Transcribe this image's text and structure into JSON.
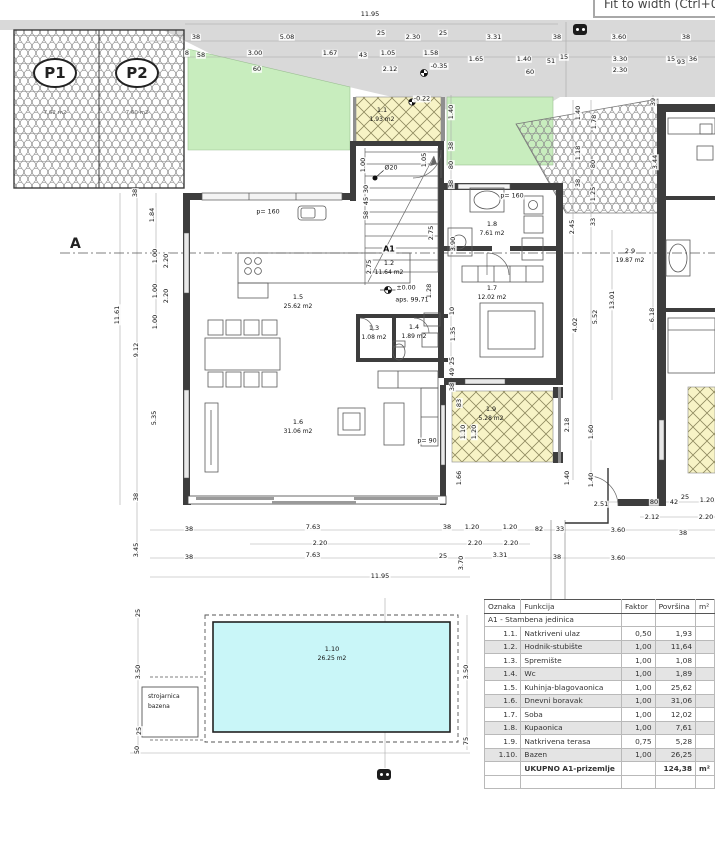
{
  "viewer": {
    "tooltip": "Fit to width (Ctrl+0)"
  },
  "section": {
    "label": "A"
  },
  "annotations": {
    "unit": "A1",
    "level_zero": "±0.00",
    "level_abs": "aps. 99,71",
    "elev_road": "-0.35",
    "elev_porch": "-0.22",
    "column": "Ø20",
    "parapet_kitchen": "p= 160",
    "parapet_bath": "p= 160",
    "parapet_living": "p= 90"
  },
  "parking": {
    "p1": {
      "label": "P1",
      "area": "7,62 m2"
    },
    "p2": {
      "label": "P2",
      "area": "7,60 m2"
    }
  },
  "rooms": {
    "r11": {
      "no": "1.1",
      "area": "1.93 m2"
    },
    "r12": {
      "no": "1.2",
      "area": "11.64 m2"
    },
    "r13": {
      "no": "1.3",
      "area": "1.08 m2"
    },
    "r14": {
      "no": "1.4",
      "area": "1.89 m2"
    },
    "r15": {
      "no": "1.5",
      "area": "25.62 m2"
    },
    "r16": {
      "no": "1.6",
      "area": "31.06 m2"
    },
    "r17": {
      "no": "1.7",
      "area": "12.02 m2"
    },
    "r18": {
      "no": "1.8",
      "area": "7.61 m2"
    },
    "r19": {
      "no": "1.9",
      "area": "5.28 m2"
    },
    "r110": {
      "no": "1.10",
      "area": "26.25 m2"
    },
    "r29": {
      "no": "2.9",
      "area": "19.87 m2"
    }
  },
  "pool": {
    "machine_room_line1": "strojarnica",
    "machine_room_line2": "bazena"
  },
  "legend": {
    "headers": [
      "Oznaka",
      "Funkcija",
      "Faktor",
      "Površina",
      "m²"
    ],
    "group": "A1 - Stambena jedinica",
    "rows": [
      [
        "1.1.",
        "Natkriveni ulaz",
        "0,50",
        "1,93"
      ],
      [
        "1.2.",
        "Hodnik-stubište",
        "1,00",
        "11,64"
      ],
      [
        "1.3.",
        "Spremište",
        "1,00",
        "1,08"
      ],
      [
        "1.4.",
        "Wc",
        "1,00",
        "1,89"
      ],
      [
        "1.5.",
        "Kuhinja-blagovaonica",
        "1,00",
        "25,62"
      ],
      [
        "1.6.",
        "Dnevni boravak",
        "1,00",
        "31,06"
      ],
      [
        "1.7.",
        "Soba",
        "1,00",
        "12,02"
      ],
      [
        "1.8.",
        "Kupaonica",
        "1,00",
        "7,61"
      ],
      [
        "1.9.",
        "Natkrivena terasa",
        "0,75",
        "5,28"
      ],
      [
        "1.10.",
        "Bazen",
        "1,00",
        "26,25"
      ]
    ],
    "total": {
      "label": "UKUPNO A1-prizemlje",
      "value": "124,38",
      "unit": "m²"
    }
  },
  "colors": {
    "road": "#d9d9d9",
    "grass": "#c8edbe",
    "terrace": "#f7f3c6",
    "pool": "#c9f6f8",
    "wall": "#3d3d3d"
  },
  "dims": [
    {
      "t": "11.95",
      "x": 370,
      "y": 14
    },
    {
      "t": "38",
      "x": 196,
      "y": 37
    },
    {
      "t": "5.08",
      "x": 287,
      "y": 37
    },
    {
      "t": "25",
      "x": 381,
      "y": 33
    },
    {
      "t": "2.30",
      "x": 413,
      "y": 37
    },
    {
      "t": "25",
      "x": 443,
      "y": 33
    },
    {
      "t": "3.31",
      "x": 494,
      "y": 37
    },
    {
      "t": "38",
      "x": 557,
      "y": 37
    },
    {
      "t": "3.60",
      "x": 619,
      "y": 37
    },
    {
      "t": "38",
      "x": 686,
      "y": 37
    },
    {
      "t": "8",
      "x": 187,
      "y": 53
    },
    {
      "t": "58",
      "x": 201,
      "y": 55
    },
    {
      "t": "3.00",
      "x": 255,
      "y": 53
    },
    {
      "t": "1.67",
      "x": 330,
      "y": 53
    },
    {
      "t": "43",
      "x": 363,
      "y": 55
    },
    {
      "t": "1.05",
      "x": 388,
      "y": 53
    },
    {
      "t": "1.58",
      "x": 431,
      "y": 53
    },
    {
      "t": "1.65",
      "x": 476,
      "y": 59
    },
    {
      "t": "1.40",
      "x": 524,
      "y": 59
    },
    {
      "t": "51",
      "x": 551,
      "y": 61
    },
    {
      "t": "15",
      "x": 564,
      "y": 57
    },
    {
      "t": "3.30",
      "x": 620,
      "y": 59
    },
    {
      "t": "15",
      "x": 671,
      "y": 59
    },
    {
      "t": "93",
      "x": 681,
      "y": 62
    },
    {
      "t": "36",
      "x": 693,
      "y": 59
    },
    {
      "t": "60",
      "x": 257,
      "y": 69
    },
    {
      "t": "2.12",
      "x": 390,
      "y": 69
    },
    {
      "t": "60",
      "x": 530,
      "y": 72
    },
    {
      "t": "2.30",
      "x": 620,
      "y": 70
    },
    {
      "t": "-0.35",
      "x": 439,
      "y": 66
    },
    {
      "t": "1.40",
      "x": 451,
      "y": 112,
      "r": 1
    },
    {
      "t": "38",
      "x": 451,
      "y": 146,
      "r": 1
    },
    {
      "t": "80",
      "x": 451,
      "y": 165,
      "r": 1
    },
    {
      "t": "38",
      "x": 451,
      "y": 184,
      "r": 1
    },
    {
      "t": "1.40",
      "x": 578,
      "y": 113,
      "r": 1
    },
    {
      "t": "1.78",
      "x": 594,
      "y": 122,
      "r": 1
    },
    {
      "t": "1.18",
      "x": 578,
      "y": 153,
      "r": 1
    },
    {
      "t": "80",
      "x": 593,
      "y": 164,
      "r": 1
    },
    {
      "t": "38",
      "x": 578,
      "y": 183,
      "r": 1
    },
    {
      "t": "1.25",
      "x": 593,
      "y": 194,
      "r": 1
    },
    {
      "t": "33",
      "x": 593,
      "y": 222,
      "r": 1
    },
    {
      "t": "2.45",
      "x": 572,
      "y": 227,
      "r": 1
    },
    {
      "t": "3.44",
      "x": 655,
      "y": 162,
      "r": 1
    },
    {
      "t": "39",
      "x": 653,
      "y": 102,
      "r": 1
    },
    {
      "t": "3.90",
      "x": 453,
      "y": 244,
      "r": 1
    },
    {
      "t": "1.00",
      "x": 363,
      "y": 165,
      "r": 1
    },
    {
      "t": "1.05",
      "x": 424,
      "y": 160,
      "r": 1
    },
    {
      "t": "30",
      "x": 366,
      "y": 189,
      "r": 1
    },
    {
      "t": "45",
      "x": 366,
      "y": 201,
      "r": 1
    },
    {
      "t": "58",
      "x": 366,
      "y": 215,
      "r": 1
    },
    {
      "t": "2.75",
      "x": 369,
      "y": 267,
      "r": 1
    },
    {
      "t": "2.75",
      "x": 431,
      "y": 233,
      "r": 1
    },
    {
      "t": "1.28",
      "x": 429,
      "y": 291,
      "r": 1
    },
    {
      "t": "10",
      "x": 452,
      "y": 311,
      "r": 1
    },
    {
      "t": "1.35",
      "x": 453,
      "y": 334,
      "r": 1
    },
    {
      "t": "25",
      "x": 452,
      "y": 361,
      "r": 1
    },
    {
      "t": "49",
      "x": 452,
      "y": 372,
      "r": 1
    },
    {
      "t": "38",
      "x": 452,
      "y": 387,
      "r": 1
    },
    {
      "t": "38",
      "x": 135,
      "y": 193,
      "r": 1
    },
    {
      "t": "1.84",
      "x": 152,
      "y": 215,
      "r": 1
    },
    {
      "t": "1.00",
      "x": 155,
      "y": 256,
      "r": 1
    },
    {
      "t": "2.20",
      "x": 166,
      "y": 261,
      "r": 1
    },
    {
      "t": "1.00",
      "x": 155,
      "y": 291,
      "r": 1
    },
    {
      "t": "2.20",
      "x": 166,
      "y": 296,
      "r": 1
    },
    {
      "t": "1.00",
      "x": 155,
      "y": 322,
      "r": 1
    },
    {
      "t": "11.61",
      "x": 117,
      "y": 315,
      "r": 1
    },
    {
      "t": "9.12",
      "x": 136,
      "y": 350,
      "r": 1
    },
    {
      "t": "5.35",
      "x": 154,
      "y": 418,
      "r": 1
    },
    {
      "t": "38",
      "x": 136,
      "y": 497,
      "r": 1
    },
    {
      "t": "3.45",
      "x": 136,
      "y": 550,
      "r": 1
    },
    {
      "t": "4.02",
      "x": 575,
      "y": 325,
      "r": 1
    },
    {
      "t": "5.52",
      "x": 595,
      "y": 317,
      "r": 1
    },
    {
      "t": "13.01",
      "x": 612,
      "y": 300,
      "r": 1
    },
    {
      "t": "6.18",
      "x": 652,
      "y": 315,
      "r": 1
    },
    {
      "t": "83",
      "x": 459,
      "y": 403,
      "r": 1
    },
    {
      "t": "1.10",
      "x": 463,
      "y": 432,
      "r": 1
    },
    {
      "t": "1.20",
      "x": 474,
      "y": 432,
      "r": 1
    },
    {
      "t": "1.66",
      "x": 459,
      "y": 478,
      "r": 1
    },
    {
      "t": "2.18",
      "x": 567,
      "y": 425,
      "r": 1
    },
    {
      "t": "1.60",
      "x": 591,
      "y": 432,
      "r": 1
    },
    {
      "t": "1.40",
      "x": 567,
      "y": 478,
      "r": 1
    },
    {
      "t": "1.40",
      "x": 591,
      "y": 480,
      "r": 1
    },
    {
      "t": "38",
      "x": 189,
      "y": 529
    },
    {
      "t": "7.63",
      "x": 313,
      "y": 527
    },
    {
      "t": "2.20",
      "x": 320,
      "y": 543
    },
    {
      "t": "38",
      "x": 189,
      "y": 557
    },
    {
      "t": "7.63",
      "x": 313,
      "y": 555
    },
    {
      "t": "11.95",
      "x": 380,
      "y": 576
    },
    {
      "t": "38",
      "x": 447,
      "y": 527
    },
    {
      "t": "1.20",
      "x": 472,
      "y": 527
    },
    {
      "t": "1.20",
      "x": 510,
      "y": 527
    },
    {
      "t": "82",
      "x": 539,
      "y": 529
    },
    {
      "t": "33",
      "x": 560,
      "y": 529
    },
    {
      "t": "2.20",
      "x": 475,
      "y": 543
    },
    {
      "t": "2.20",
      "x": 511,
      "y": 543
    },
    {
      "t": "25",
      "x": 443,
      "y": 556
    },
    {
      "t": "3.70",
      "x": 461,
      "y": 563,
      "r": 1
    },
    {
      "t": "3.31",
      "x": 500,
      "y": 555
    },
    {
      "t": "38",
      "x": 557,
      "y": 557
    },
    {
      "t": "2.51",
      "x": 601,
      "y": 504
    },
    {
      "t": "80",
      "x": 654,
      "y": 502
    },
    {
      "t": "42",
      "x": 674,
      "y": 502
    },
    {
      "t": "25",
      "x": 685,
      "y": 497
    },
    {
      "t": "1.20",
      "x": 707,
      "y": 500
    },
    {
      "t": "2.12",
      "x": 652,
      "y": 517
    },
    {
      "t": "2.20",
      "x": 706,
      "y": 517
    },
    {
      "t": "3.60",
      "x": 618,
      "y": 530
    },
    {
      "t": "38",
      "x": 683,
      "y": 533
    },
    {
      "t": "3.60",
      "x": 618,
      "y": 558
    },
    {
      "t": "25",
      "x": 138,
      "y": 613,
      "r": 1
    },
    {
      "t": "3.50",
      "x": 138,
      "y": 672,
      "r": 1
    },
    {
      "t": "25",
      "x": 139,
      "y": 731,
      "r": 1
    },
    {
      "t": "50",
      "x": 137,
      "y": 750,
      "r": 1
    },
    {
      "t": "3.50",
      "x": 466,
      "y": 672,
      "r": 1
    },
    {
      "t": "75",
      "x": 466,
      "y": 741,
      "r": 1
    }
  ]
}
